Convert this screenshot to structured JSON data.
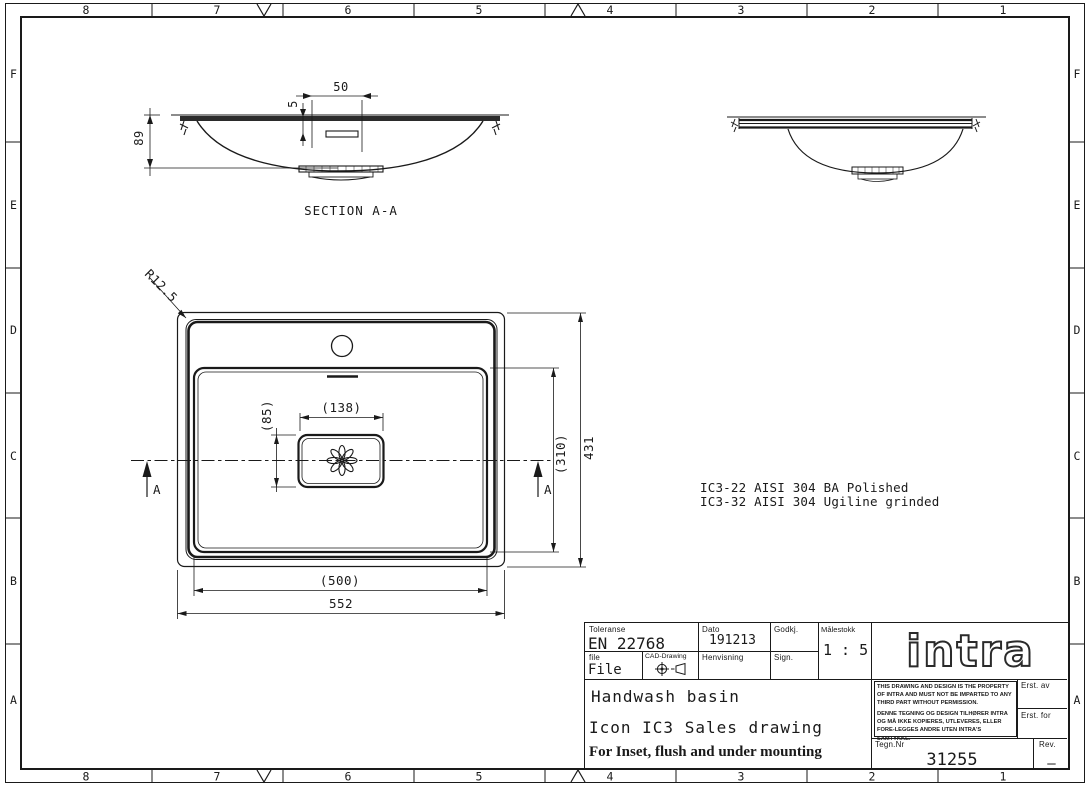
{
  "frame": {
    "top": [
      "8",
      "7",
      "6",
      "5",
      "4",
      "3",
      "2",
      "1"
    ],
    "bottom": [
      "8",
      "7",
      "6",
      "5",
      "4",
      "3",
      "2",
      "1"
    ],
    "left": [
      "F",
      "E",
      "D",
      "C",
      "B",
      "A"
    ],
    "right": [
      "F",
      "E",
      "D",
      "C",
      "B",
      "A"
    ]
  },
  "views": {
    "section": {
      "title": "SECTION A-A",
      "dim_recess_width": "50",
      "dim_recess_depth": "5",
      "dim_height": "89"
    },
    "plan": {
      "corner_radius": "R12.5",
      "drain_width": "(138)",
      "drain_height": "(85)",
      "bowl_depth": "(310)",
      "overall_depth": "431",
      "bowl_width": "(500)",
      "overall_width": "552",
      "marker_left": "A",
      "marker_right": "A"
    }
  },
  "notes": {
    "variant1": "IC3-22 AISI 304 BA Polished",
    "variant2": "IC3-32 AISI 304 Ugiline grinded"
  },
  "title_block": {
    "toleranse_label": "Toleranse",
    "toleranse_value": "EN 22768",
    "dato_label": "Dato",
    "dato_value": "191213",
    "godkj_label": "Godkj.",
    "malestokk_label": "Målestokk",
    "malestokk_value": "1 : 5",
    "file_label": "file",
    "file_value": "File",
    "cad_label": "CAD-Drawing",
    "henvisning_label": "Henvisning",
    "sign_label": "Sign.",
    "logo_text": "intra",
    "title_line1": "Handwash basin",
    "title_line2": "Icon IC3 Sales drawing",
    "title_line3": "For Inset, flush and under mounting",
    "property_en": "THIS DRAWING AND DESIGN IS THE PROPERTY OF INTRA AND MUST NOT BE IMPARTED TO ANY THIRD PART WITHOUT PERMISSION.",
    "property_no": "DENNE TEGNING OG DESIGN TILHØRER INTRA OG MÅ IKKE KOPIERES, UTLEVERES, ELLER FORE-LEGGES ANDRE UTEN INTRA'S SAMTYKKE.",
    "erst_av_label": "Erst. av",
    "erst_for_label": "Erst. for",
    "tegnnr_label": "Tegn.Nr",
    "tegnnr_value": "31255",
    "rev_label": "Rev.",
    "rev_value": "—"
  },
  "colors": {
    "line": "#1a1a1a",
    "background": "#ffffff"
  }
}
